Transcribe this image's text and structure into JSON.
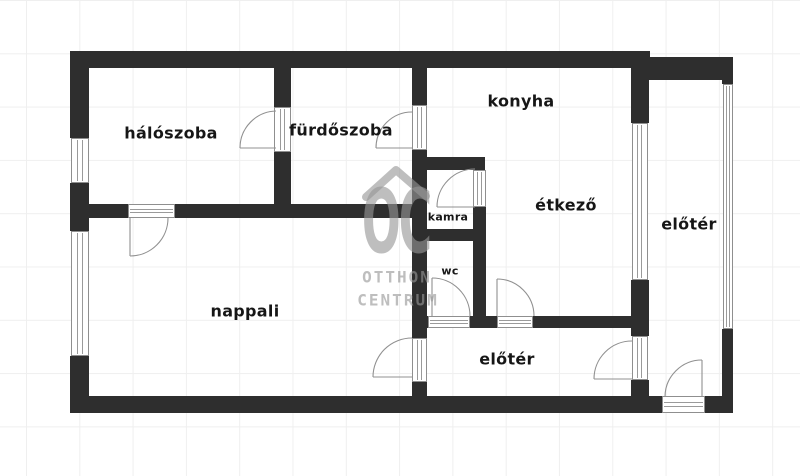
{
  "canvas": {
    "width": 800,
    "height": 476
  },
  "style": {
    "background": "#ffffff",
    "wall_color": "#2e2e2e",
    "door_window_line_color": "#909090",
    "label_color": "#161616",
    "grid_color": "#efefef",
    "watermark_color": "rgba(150,150,150,0.62)"
  },
  "rooms": [
    {
      "id": "haloszoba",
      "label": "hálószoba",
      "cx": 171,
      "cy": 133,
      "fs": 16
    },
    {
      "id": "furdoszoba",
      "label": "fürdőszoba",
      "cx": 341,
      "cy": 130,
      "fs": 16
    },
    {
      "id": "konyha",
      "label": "konyha",
      "cx": 521,
      "cy": 101,
      "fs": 16
    },
    {
      "id": "etkezo",
      "label": "étkező",
      "cx": 566,
      "cy": 205,
      "fs": 16
    },
    {
      "id": "eloter-jobb",
      "label": "előtér",
      "cx": 689,
      "cy": 224,
      "fs": 16
    },
    {
      "id": "nappali",
      "label": "nappali",
      "cx": 245,
      "cy": 311,
      "fs": 16
    },
    {
      "id": "eloter-also",
      "label": "előtér",
      "cx": 507,
      "cy": 359,
      "fs": 16
    },
    {
      "id": "kamra",
      "label": "kamra",
      "cx": 448,
      "cy": 217,
      "fs": 11
    },
    {
      "id": "wc",
      "label": "wc",
      "cx": 450,
      "cy": 271,
      "fs": 11
    }
  ],
  "plan": {
    "walls": [
      [
        70,
        51,
        580,
        17
      ],
      [
        70,
        68,
        19,
        70
      ],
      [
        70,
        183,
        19,
        48
      ],
      [
        70,
        356,
        19,
        41
      ],
      [
        70,
        396,
        578,
        17
      ],
      [
        72,
        204,
        56,
        14
      ],
      [
        175,
        204,
        249,
        14
      ],
      [
        274,
        68,
        17,
        39
      ],
      [
        274,
        152,
        17,
        52
      ],
      [
        412,
        68,
        15,
        37
      ],
      [
        412,
        150,
        15,
        188
      ],
      [
        412,
        382,
        15,
        15
      ],
      [
        423,
        157,
        62,
        13
      ],
      [
        473,
        207,
        13,
        22
      ],
      [
        412,
        229,
        74,
        12
      ],
      [
        473,
        241,
        13,
        75
      ],
      [
        412,
        316,
        16,
        12
      ],
      [
        470,
        316,
        27,
        12
      ],
      [
        533,
        316,
        98,
        12
      ],
      [
        631,
        68,
        18,
        55
      ],
      [
        631,
        280,
        18,
        56
      ],
      [
        631,
        380,
        18,
        17
      ],
      [
        648,
        57,
        85,
        23
      ],
      [
        722,
        78,
        11,
        6
      ],
      [
        722,
        329,
        11,
        68
      ],
      [
        648,
        396,
        14,
        17
      ],
      [
        705,
        396,
        28,
        17
      ]
    ],
    "windows": [
      {
        "rect": [
          71,
          138,
          18,
          45
        ],
        "dir": "v"
      },
      {
        "rect": [
          71,
          231,
          18,
          125
        ],
        "dir": "v"
      },
      {
        "rect": [
          632,
          123,
          16,
          157
        ],
        "dir": "v"
      },
      {
        "rect": [
          723,
          84,
          10,
          245
        ],
        "dir": "v"
      }
    ],
    "door_openings": [
      {
        "rect": [
          128,
          204,
          47,
          14
        ],
        "dir": "h"
      },
      {
        "rect": [
          274,
          107,
          17,
          45
        ],
        "dir": "v"
      },
      {
        "rect": [
          412,
          105,
          15,
          45
        ],
        "dir": "v"
      },
      {
        "rect": [
          473,
          170,
          13,
          37
        ],
        "dir": "v"
      },
      {
        "rect": [
          428,
          316,
          42,
          12
        ],
        "dir": "h"
      },
      {
        "rect": [
          497,
          316,
          36,
          12
        ],
        "dir": "h"
      },
      {
        "rect": [
          412,
          338,
          15,
          44
        ],
        "dir": "v"
      },
      {
        "rect": [
          632,
          336,
          16,
          44
        ],
        "dir": "v"
      },
      {
        "rect": [
          662,
          396,
          43,
          17
        ],
        "dir": "h"
      }
    ],
    "doors": [
      {
        "arc": "M240,148 A37,37 0 0 1 276,111",
        "leaf": [
          240,
          148,
          276,
          148
        ]
      },
      {
        "arc": "M376,148 A36,36 0 0 1 412,112",
        "leaf": [
          376,
          148,
          412,
          148
        ]
      },
      {
        "arc": "M130,256 A38,38 0 0 0 168,218",
        "leaf": [
          130,
          218,
          130,
          256
        ]
      },
      {
        "arc": "M437,207 A38,38 0 0 1 475,169",
        "leaf": [
          437,
          207,
          475,
          207
        ]
      },
      {
        "arc": "M432,278 A38,38 0 0 1 470,316",
        "leaf": [
          432,
          278,
          432,
          316
        ]
      },
      {
        "arc": "M497,279 A37,37 0 0 1 534,316",
        "leaf": [
          497,
          279,
          497,
          316
        ]
      },
      {
        "arc": "M373,377 A39,39 0 0 1 412,338",
        "leaf": [
          373,
          377,
          412,
          377
        ]
      },
      {
        "arc": "M594,379 A38,38 0 0 1 632,341",
        "leaf": [
          594,
          379,
          632,
          379
        ]
      },
      {
        "arc": "M665,397 A37,37 0 0 1 702,360",
        "leaf": [
          702,
          360,
          702,
          397
        ]
      }
    ]
  },
  "watermark": {
    "monogram": "OC",
    "line1": "OTTHON",
    "line2": "CENTRUM",
    "roof_path": "M366,197 L396,170 L426,196",
    "monogram_cx": 396,
    "monogram_cy": 226,
    "line1_cx": 397,
    "line1_cy": 277,
    "line2_cx": 398,
    "line2_cy": 300
  }
}
